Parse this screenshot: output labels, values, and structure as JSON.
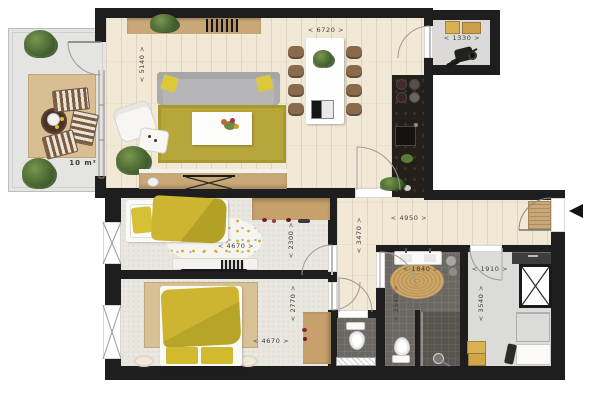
{
  "title": "apartment-floor-plan",
  "rooms": {
    "balcony": {
      "area_label": "10 m²"
    },
    "living": {
      "width_dim": "6720",
      "depth_dim": "5140"
    },
    "storage": {
      "width_dim": "1330"
    },
    "bedroom1": {
      "width_dim": "4670",
      "depth_dim": "2300"
    },
    "bedroom2": {
      "width_dim": "4670",
      "depth_dim": "2770"
    },
    "hall": {
      "width_dim": "4950",
      "depth_dim": "3470"
    },
    "bathroom": {
      "width_dim": "1840",
      "depth_dim": "3540"
    },
    "utility": {
      "width_dim": "1910",
      "depth_dim": "3540"
    }
  },
  "colors": {
    "wall": "#1e1e1e",
    "wood_floor": "#f1e8d6",
    "carpet": "#eae7e0",
    "tile_dark": "#6b6762",
    "accent_yellow": "#d2ba2e",
    "rug_olive": "#b7a63a",
    "rug_tan": "#d9be93",
    "wood_furniture": "#c9a877",
    "kitchen_black": "#232019"
  }
}
